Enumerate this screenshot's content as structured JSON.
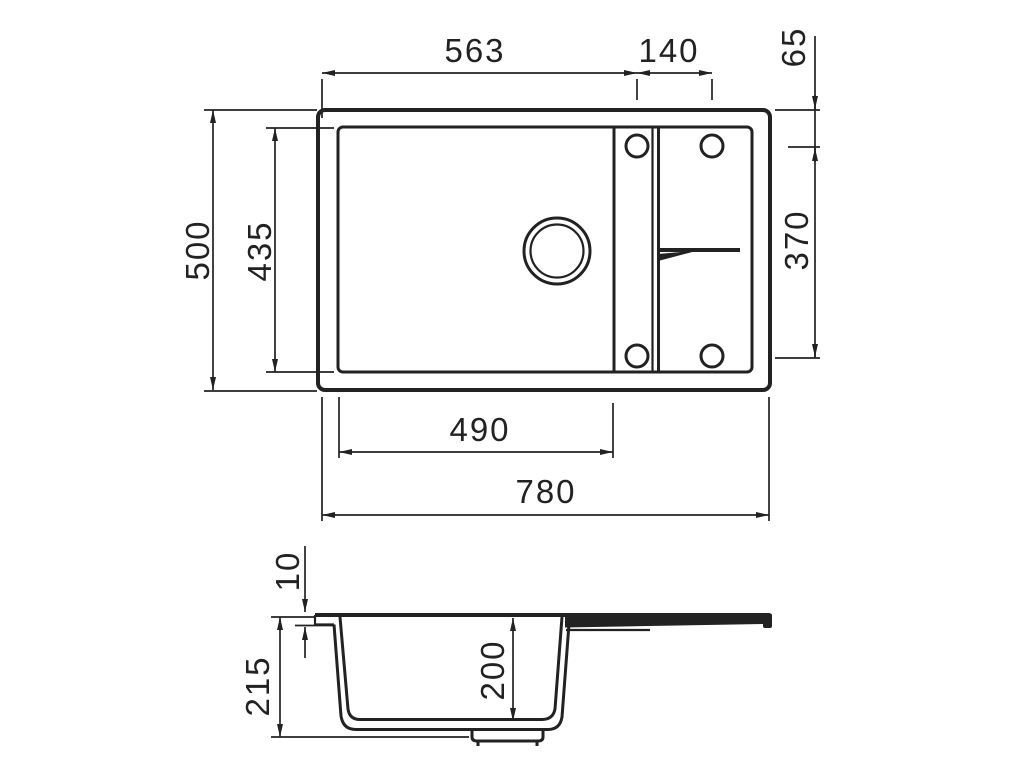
{
  "drawing": {
    "ink_color": "#222222",
    "background_color": "#ffffff",
    "top_view": {
      "dim_left_edge_to_first_hole": "563",
      "dim_hole_spacing": "140",
      "dim_top_edge_to_hole_row": "65",
      "dim_overall_depth": "500",
      "dim_inner_rim_depth": "435",
      "dim_hole_rows_spacing": "370",
      "dim_main_bowl_width": "490",
      "dim_overall_width": "780"
    },
    "section_view": {
      "dim_rim_thickness": "10",
      "dim_overall_height": "215",
      "dim_bowl_inner_depth": "200"
    }
  }
}
